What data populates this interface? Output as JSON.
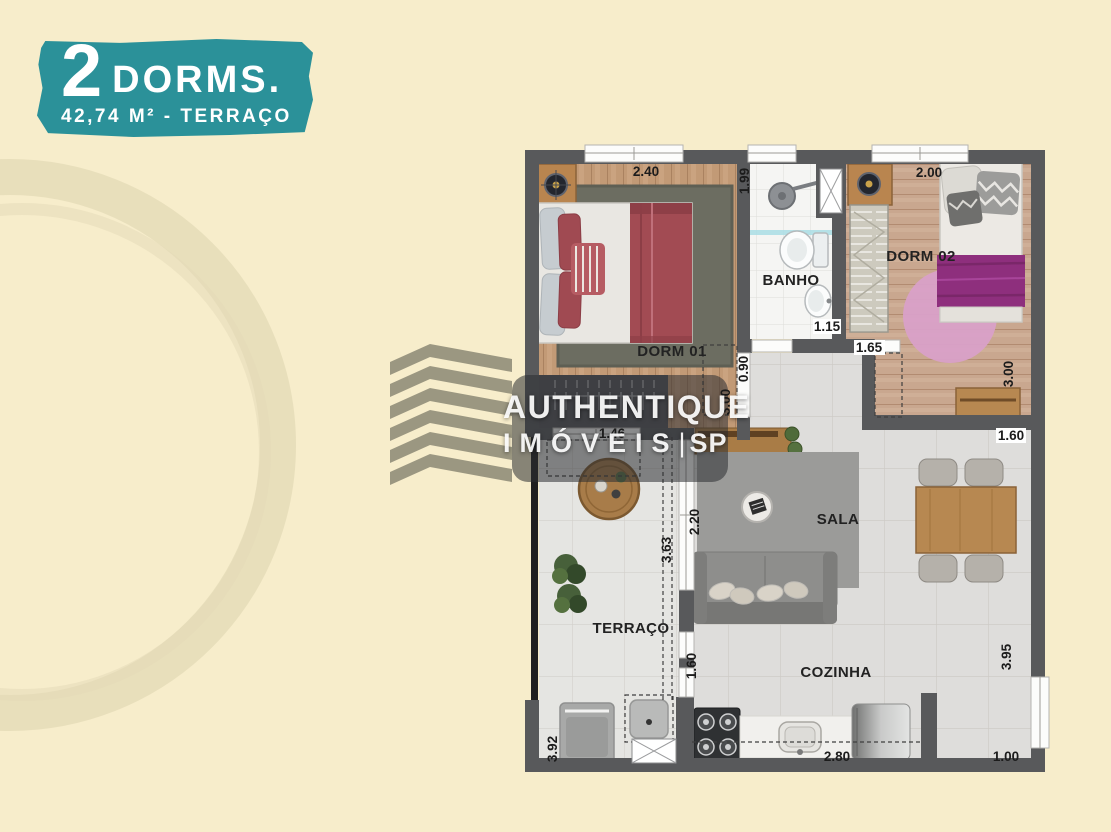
{
  "badge": {
    "number": "2",
    "type_label": "DORMS.",
    "area_label": "42,74 M² - TERRAÇO"
  },
  "watermark": {
    "brand": "AUTHENTIQUE",
    "brand_line2": "IMÓVEIS",
    "separator": "|",
    "brand_suffix": "SP"
  },
  "plan": {
    "room_labels": {
      "dorm01": "DORM 01",
      "dorm02": "DORM 02",
      "banho": "BANHO",
      "sala": "SALA",
      "terraco": "TERRAÇO",
      "cozinha": "COZINHA"
    },
    "dimensions": {
      "dorm01_width": "2.40",
      "banho_depth": "1.99",
      "dorm02_width": "2.00",
      "banho_width": "1.15",
      "dorm02_door": "1.65",
      "dorm02_depth": "3.00",
      "hall_door": "0.90",
      "hall_depth": "3.00",
      "dorm01_terrace_door": "1.46",
      "dining_width": "1.60",
      "sala_window": "2.20",
      "terraco_length": "3.63",
      "cozinha_passage": "1.60",
      "terraco_depth": "3.92",
      "cozinha_width": "2.80",
      "entry_width": "1.00",
      "cozinha_depth": "3.95"
    }
  },
  "colors": {
    "background": "#f7edcb",
    "badge_teal": "#2b9199",
    "wall": "#58595b",
    "wood_dorm01": "#c29a76",
    "wood_dorm02": "#c9a78f",
    "bed_blanket_red": "#a24b53",
    "bed_blanket_purple": "#8e2f7d",
    "rug_pink": "#d9a0c8",
    "tile": "#dedddb",
    "watermark_olive": "#8f8c77"
  }
}
